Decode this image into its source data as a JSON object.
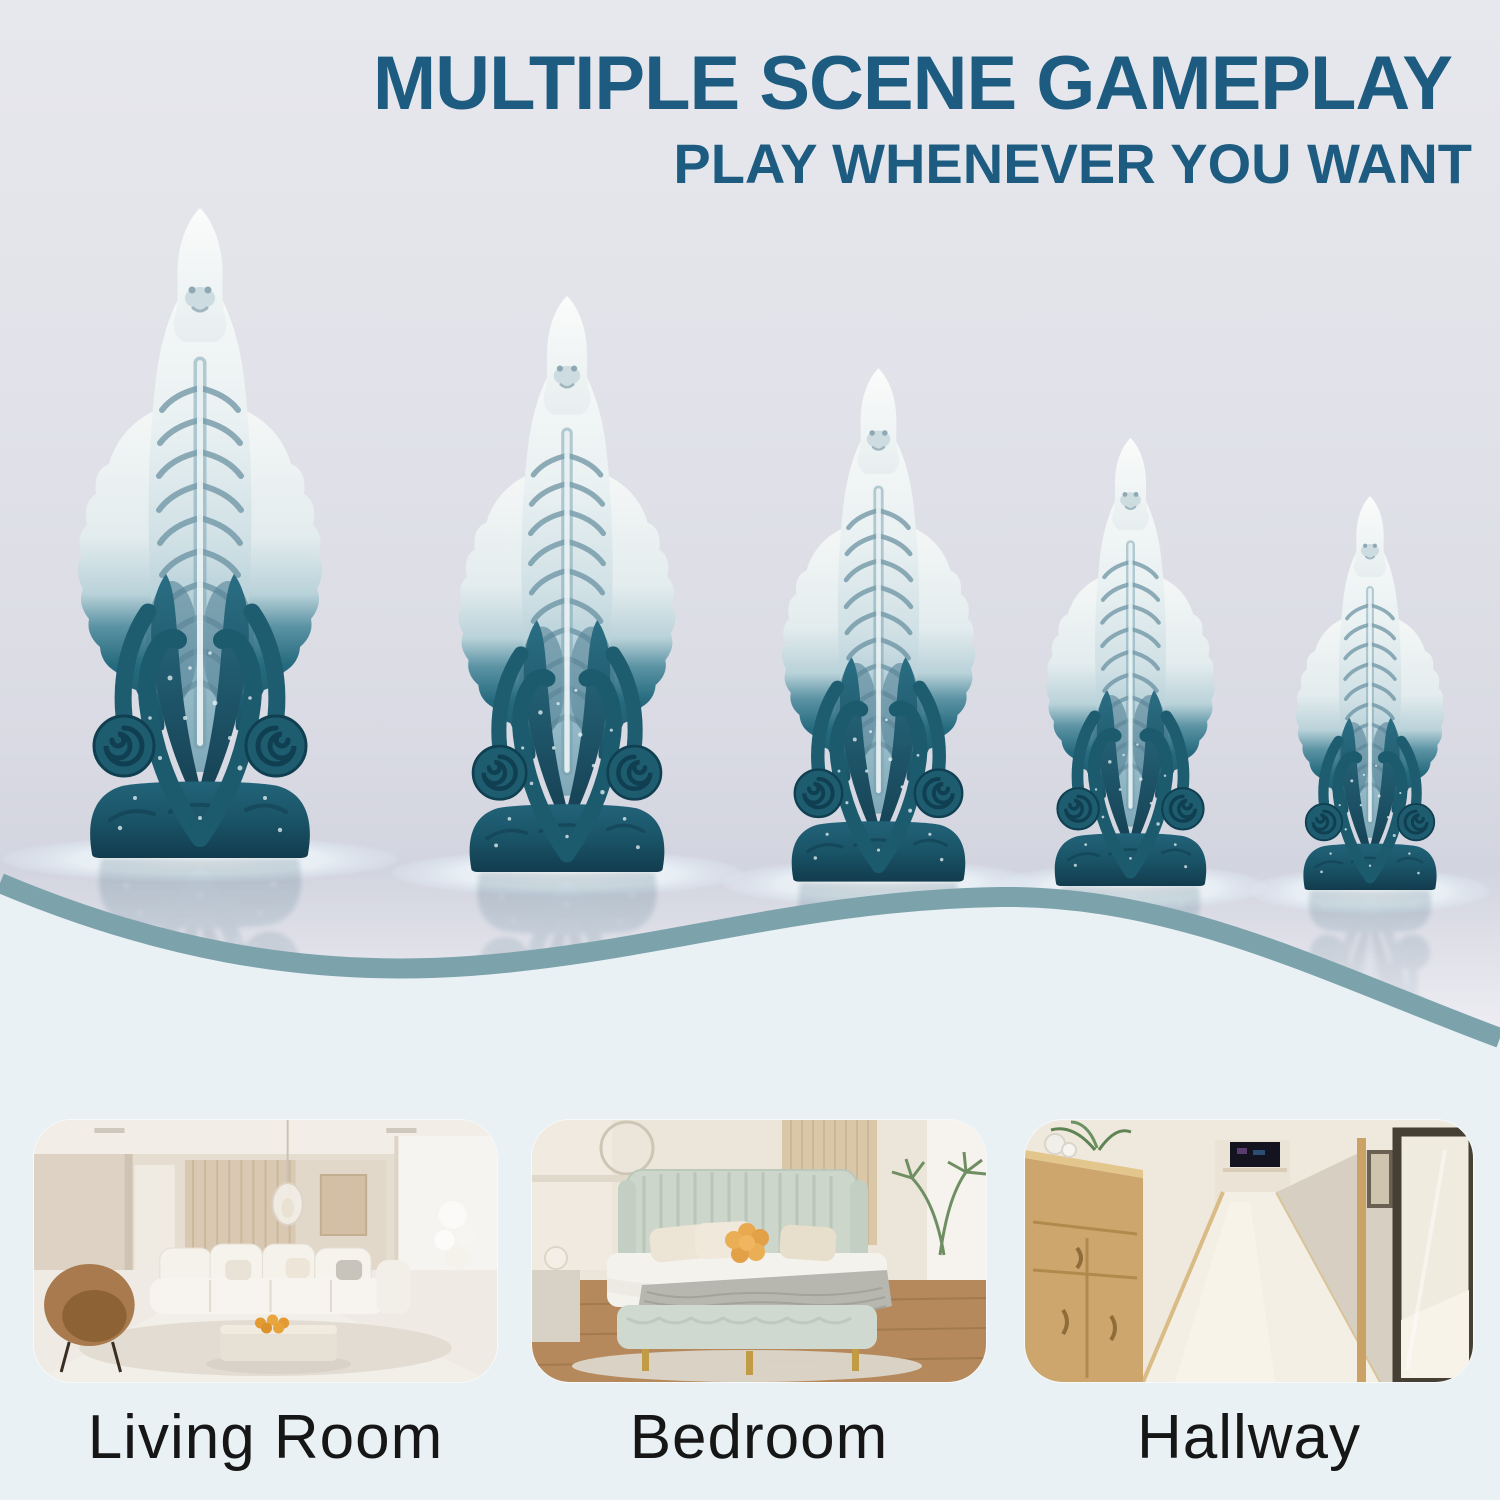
{
  "header": {
    "title": "MULTIPLE SCENE GAMEPLAY",
    "subtitle": "PLAY WHENEVER YOU WANT",
    "text_color": "#1d5c80"
  },
  "products": {
    "description": "Five matching tentacle-base fantasy figurines shown in descending sizes on a glossy white table",
    "count": 5,
    "colors": {
      "teal": "#1e5c70",
      "teal_dark": "#123f52",
      "white": "#f5f7f6",
      "pale_blue": "#9fc0cc"
    },
    "items": [
      {
        "name": "size-1-largest"
      },
      {
        "name": "size-2"
      },
      {
        "name": "size-3"
      },
      {
        "name": "size-4"
      },
      {
        "name": "size-5-smallest"
      }
    ]
  },
  "divider": {
    "wave_stroke_color": "#7ca2ac",
    "lower_background": "#e9f1f4"
  },
  "scenes": {
    "label_color": "#161616",
    "items": [
      {
        "label": "Living Room"
      },
      {
        "label": "Bedroom"
      },
      {
        "label": "Hallway"
      }
    ]
  }
}
